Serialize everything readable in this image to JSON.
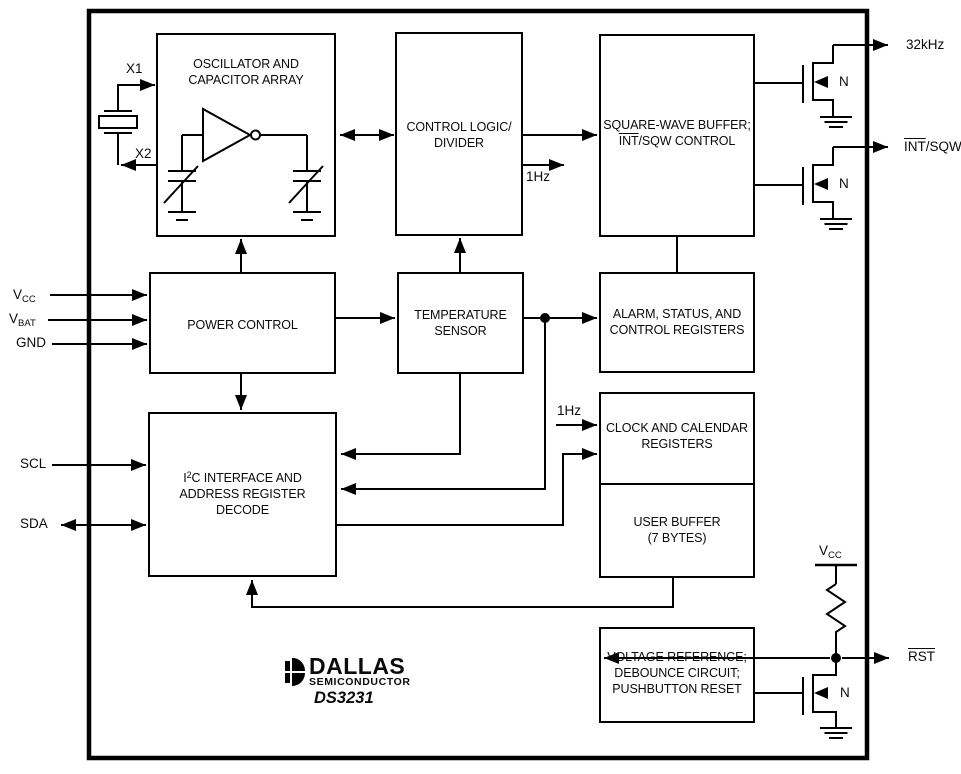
{
  "blocks": {
    "oscillator": {
      "line1": "OSCILLATOR AND",
      "line2": "CAPACITOR ARRAY"
    },
    "control_logic": {
      "line1": "CONTROL LOGIC/",
      "line2": "DIVIDER"
    },
    "sqw_buffer": {
      "line1": "SQUARE-WAVE BUFFER;",
      "line2_overlined": "INT",
      "line2_rest": "/SQW CONTROL"
    },
    "power_control": {
      "line1": "POWER CONTROL"
    },
    "temp_sensor": {
      "line1": "TEMPERATURE",
      "line2": "SENSOR"
    },
    "alarm_registers": {
      "line1": "ALARM, STATUS, AND",
      "line2": "CONTROL REGISTERS"
    },
    "i2c_interface": {
      "line1_pre": "I",
      "line1_sup": "2",
      "line1_post": "C INTERFACE AND",
      "line2": "ADDRESS REGISTER",
      "line3": "DECODE"
    },
    "clock_registers": {
      "line1": "CLOCK AND CALENDAR",
      "line2": "REGISTERS"
    },
    "user_buffer": {
      "line1": "USER BUFFER",
      "line2": "(7 BYTES)"
    },
    "voltage_reference": {
      "line1": "VOLTAGE REFERENCE;",
      "line2": "DEBOUNCE CIRCUIT;",
      "line3": "PUSHBUTTON RESET"
    }
  },
  "pins": {
    "x1": "X1",
    "x2": "X2",
    "vcc_base": "V",
    "vcc_sub": "CC",
    "vbat_base": "V",
    "vbat_sub": "BAT",
    "gnd": "GND",
    "scl": "SCL",
    "sda": "SDA",
    "out_32khz": "32kHz",
    "int_overlined": "INT",
    "int_rest": "/SQW",
    "rst": "RST"
  },
  "signals": {
    "one_hz": "1Hz",
    "nfet_label": "N"
  },
  "logo": {
    "brand": "DALLAS",
    "division": "SEMICONDUCTOR",
    "part": "DS3231"
  },
  "colors": {
    "line": "#000000",
    "background": "#ffffff",
    "text": "#0a0a0a"
  }
}
